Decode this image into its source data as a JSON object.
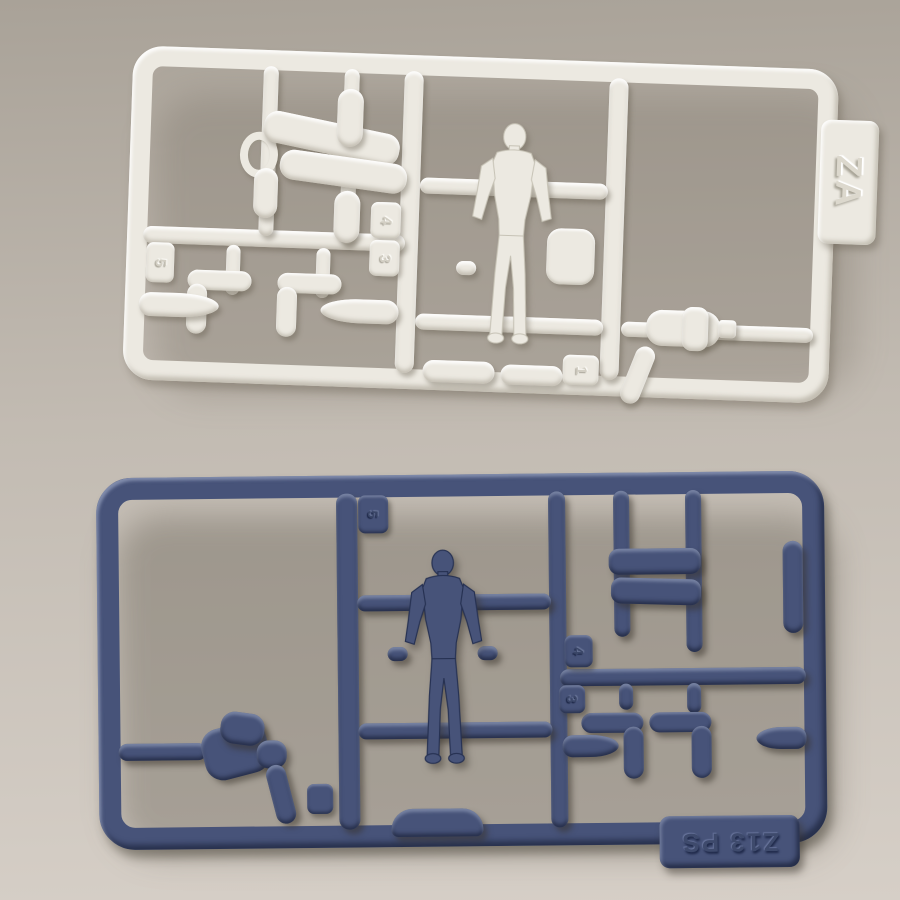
{
  "scene": {
    "description": "Photograph of two injection-molded model kit sprues (runners) with small human figure parts lying on a beige backdrop"
  },
  "colors": {
    "bg_top": "#a9a298",
    "bg_mid": "#c2bbb2",
    "bg_bottom": "#d6cfc7",
    "white_plastic": "#ece9e1",
    "blue_plastic": "#475379"
  },
  "white_sprue": {
    "tag_text": "ZA",
    "gate_numbers": [
      "5",
      "4",
      "3",
      "1"
    ]
  },
  "blue_sprue": {
    "tag_text": "Z13 PS",
    "gate_numbers": [
      "5",
      "4",
      "3"
    ]
  }
}
